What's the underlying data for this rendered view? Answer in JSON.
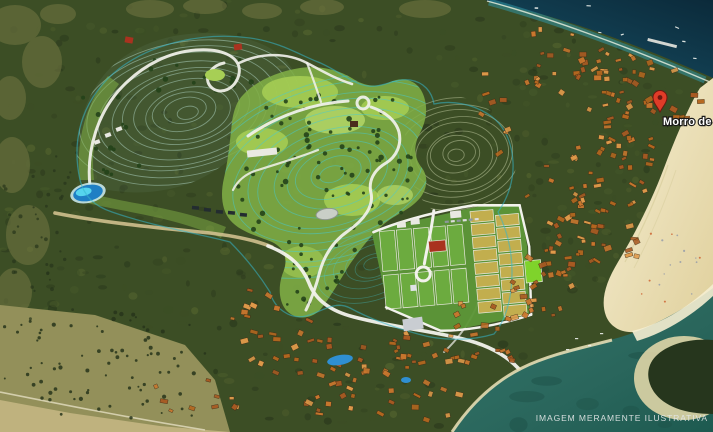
{
  "map": {
    "pin_label": "Morro de",
    "watermark": "IMAGEM MERAMENTE ILUSTRATIVA",
    "pin_icon": "map-pin-icon"
  },
  "palette": {
    "forest_dark": "#27351b",
    "forest_mid": "#3c4e25",
    "forest_light": "#55652f",
    "field_khaki": "#93905a",
    "khaki_patch": "#6e7340",
    "ocean_deep": "#0b2a3a",
    "ocean_teal": "#1e6073",
    "shore_turquoise": "#2f93a4",
    "bay_green": "#2a665c",
    "bay_dark": "#1d4f45",
    "sand": "#e9dcab",
    "sand_bright": "#f5eed2",
    "plan_green": "#7fae45",
    "plan_green_light": "#a7cf55",
    "plan_green_bright": "#c3e470",
    "contour_cyan": "#43cbd6",
    "contour_pale": "#aacdbb",
    "contour_khaki": "#b9c49a",
    "boundary_cyan": "#35b6cc",
    "road_white": "#f2f2ec",
    "road_tan": "#cfc08e",
    "roof_orange_1": "#c9772e",
    "roof_orange_2": "#a85a22",
    "roof_orange_3": "#e09a4a",
    "roof_red": "#a9321f",
    "lot_tan": "#c2ae4e",
    "lot_green": "#6cab3f",
    "lot_green_bright": "#7fd32b",
    "lawn_green": "#5d9638",
    "pool_blue": "#2f8fd2",
    "lake_blue": "#1f7fc4",
    "lake_cyan": "#55d4ee",
    "pin_red": "#e03c28",
    "pin_dark": "#6e1810",
    "building_white": "#e9e9e2",
    "vehicle_dark": "#232c30"
  }
}
